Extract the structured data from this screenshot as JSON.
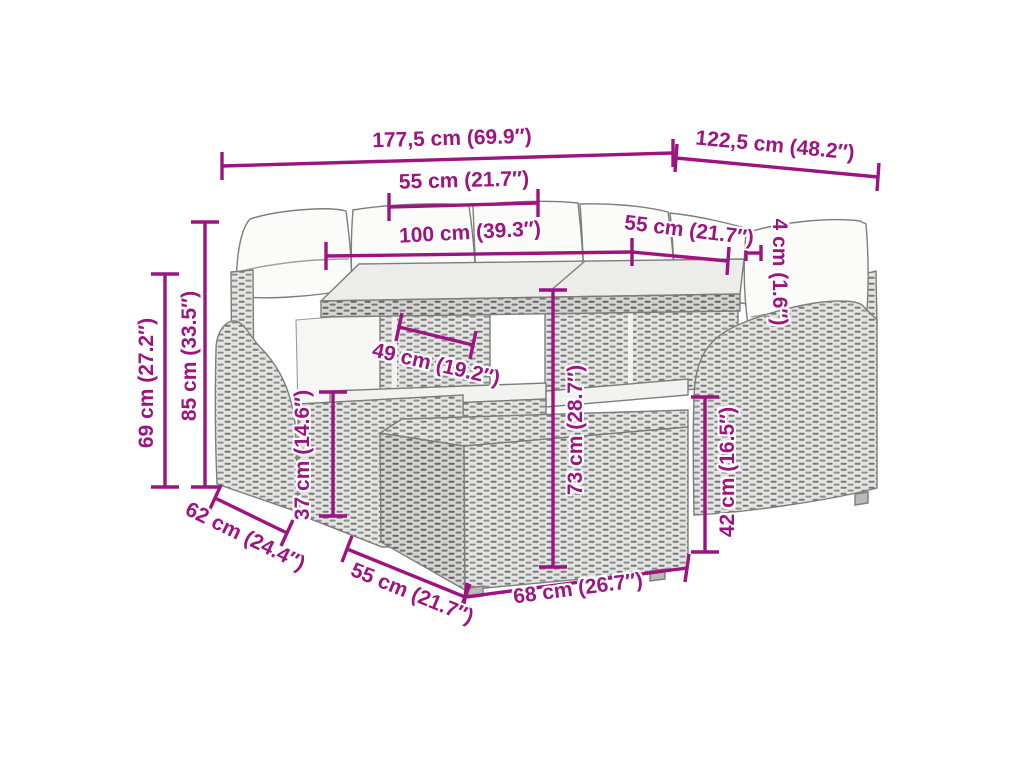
{
  "colors": {
    "accent": "#9d1480",
    "furniture_outline": "#7d7d7d",
    "rattan_light": "#e4e4e2",
    "rattan_strand": "#78787a",
    "cushion_fill": "#fbfbfa",
    "background": "#ffffff"
  },
  "dimensions": {
    "total_length": {
      "label": "177,5 cm (69.9″)"
    },
    "total_depth": {
      "label": "122,5 cm (48.2″)"
    },
    "left_seat_width": {
      "label": "55 cm (21.7″)"
    },
    "table_length": {
      "label": "100 cm (39.3″)"
    },
    "right_seat_width": {
      "label": "55 cm (21.7″)"
    },
    "tabletop_thickness": {
      "label": "4 cm (1.6″)"
    },
    "armrest_height": {
      "label": "69 cm (27.2″)"
    },
    "total_height": {
      "label": "85 cm (33.5″)"
    },
    "table_depth": {
      "label": "49 cm (19.2″)"
    },
    "seat_height": {
      "label": "37 cm (14.6″)"
    },
    "table_height": {
      "label": "73 cm (28.7″)"
    },
    "bench_height": {
      "label": "42 cm (16.5″)"
    },
    "side_depth": {
      "label": "62 cm (24.4″)"
    },
    "bench_depth": {
      "label": "55 cm (21.7″)"
    },
    "bench_width": {
      "label": "68 cm (26.7″)"
    }
  }
}
